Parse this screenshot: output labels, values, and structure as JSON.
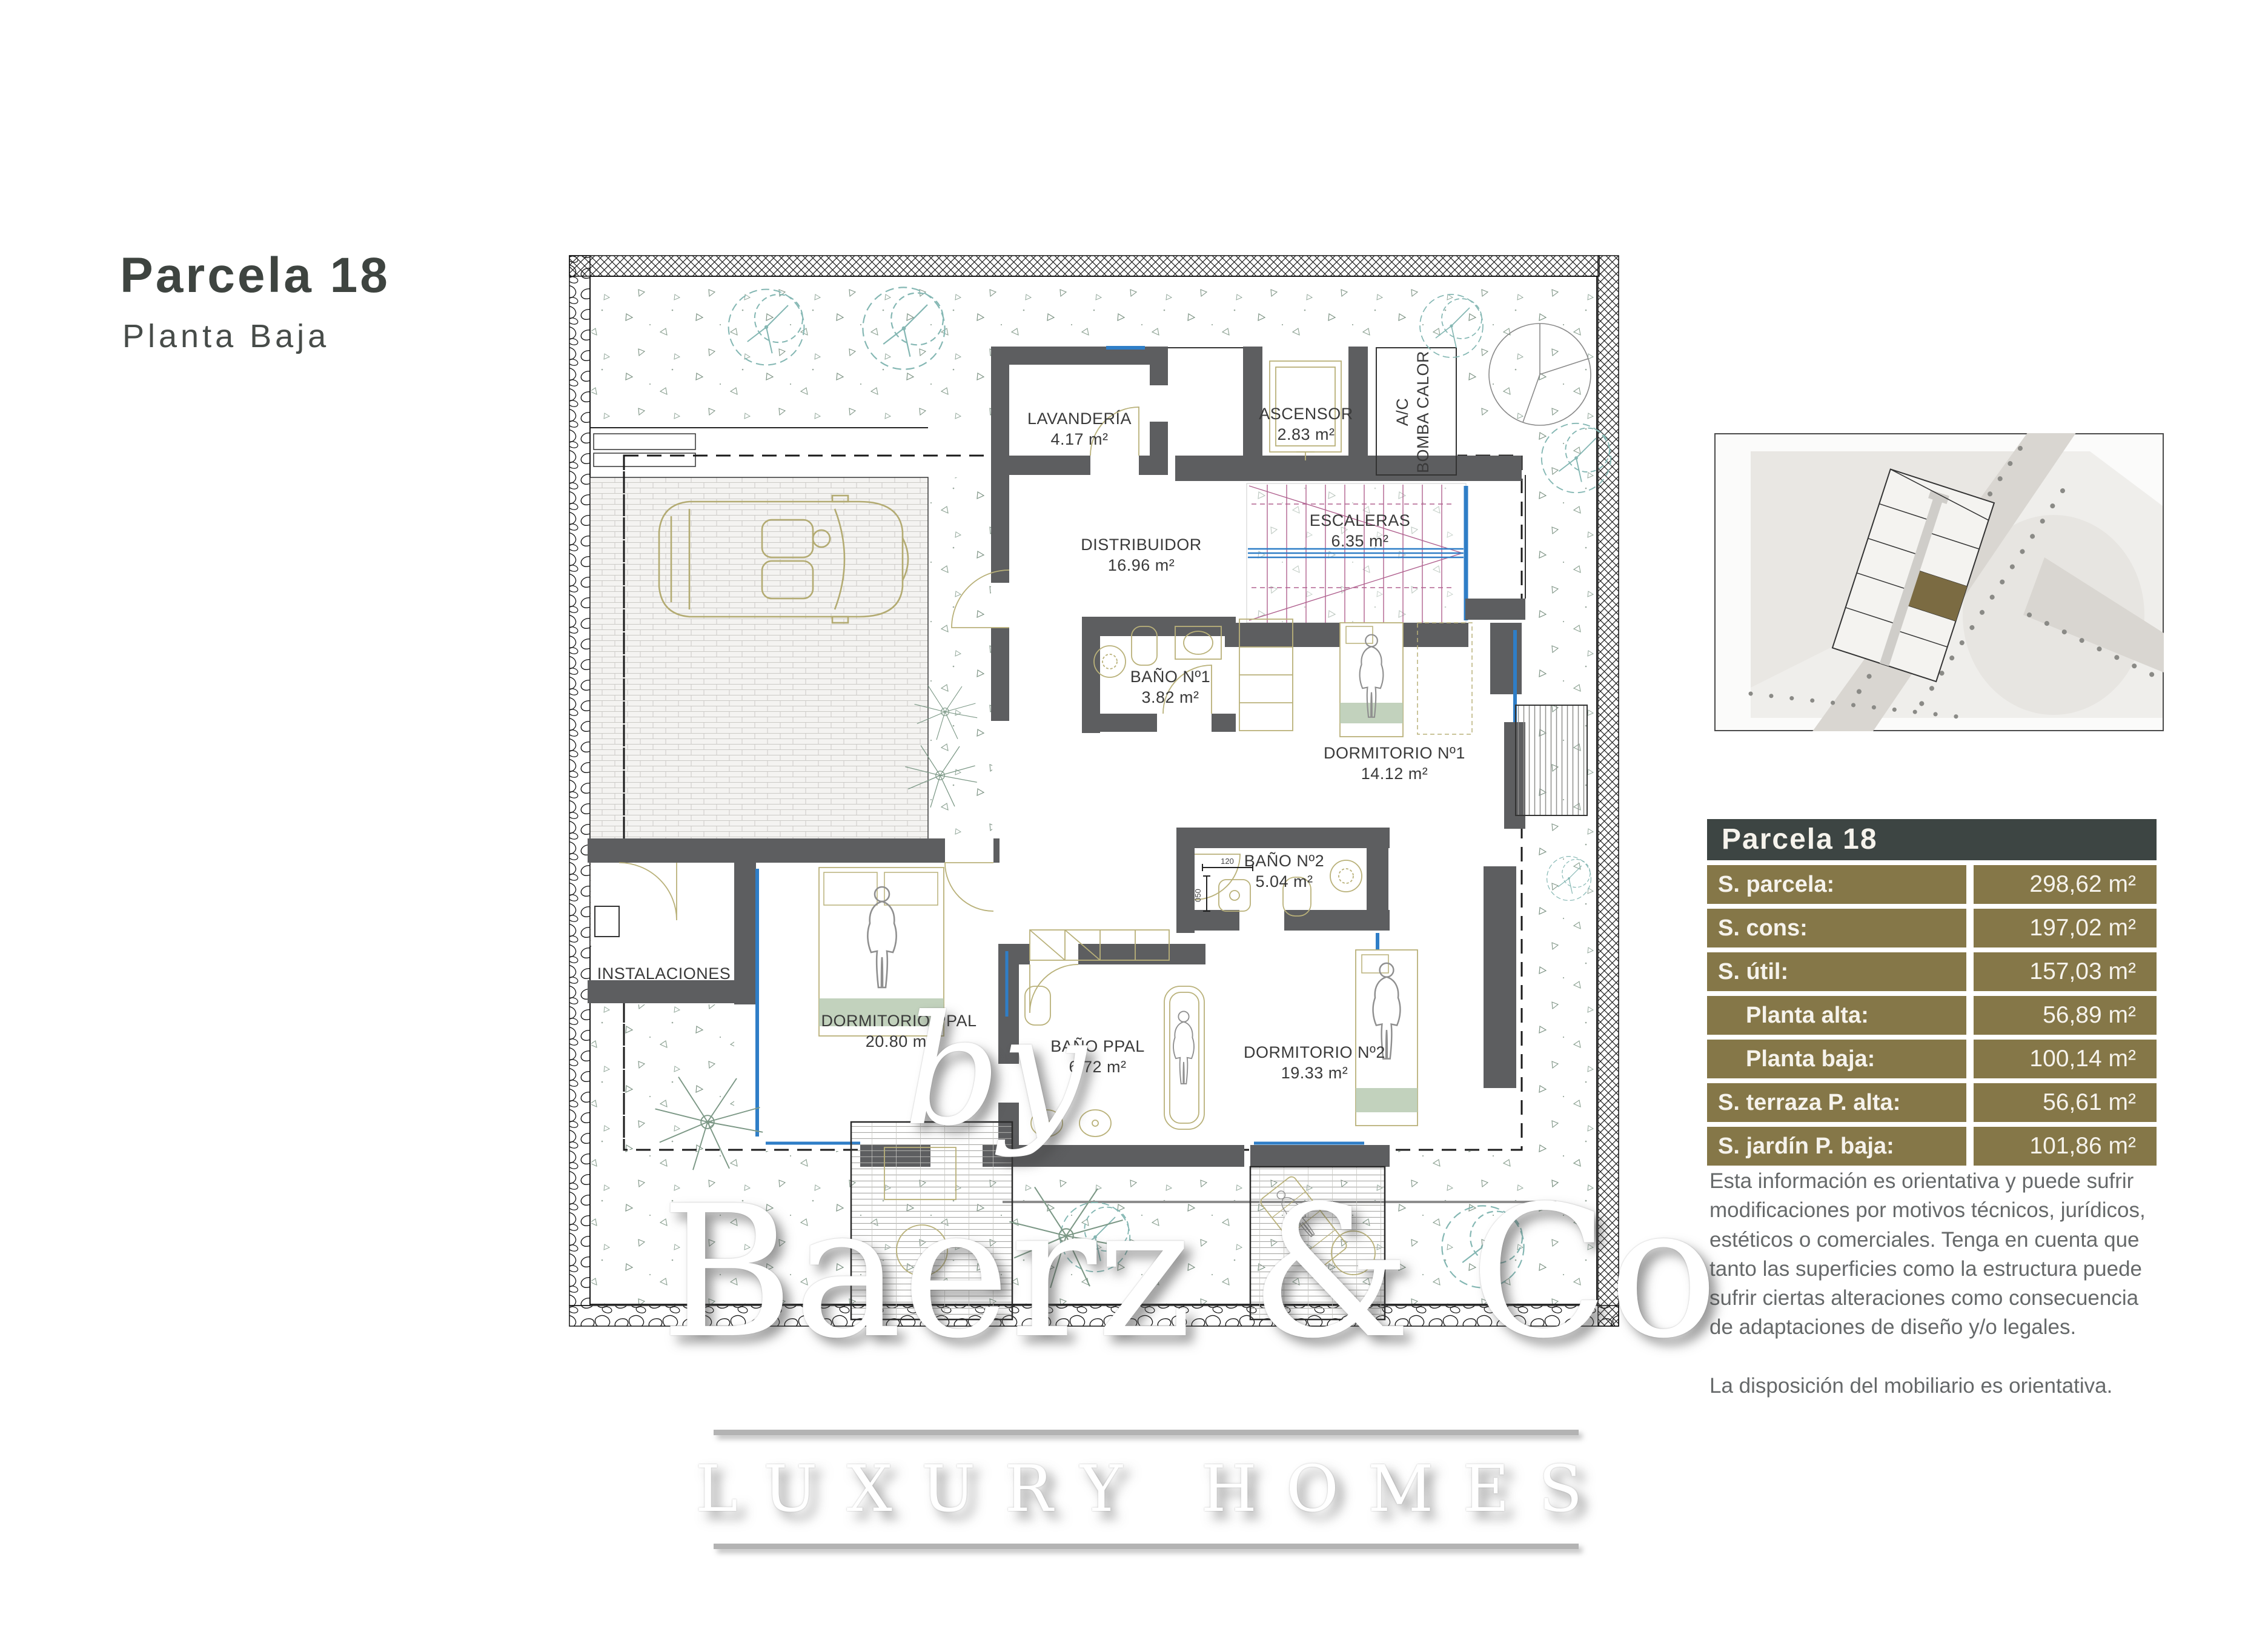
{
  "title": {
    "main": "Parcela 18",
    "subtitle": "Planta Baja"
  },
  "plan": {
    "rooms": {
      "lavanderia": {
        "name": "LAVANDERÍA",
        "area": "4.17 m²"
      },
      "ascensor": {
        "name": "ASCENSOR",
        "area": "2.83 m²"
      },
      "ac": {
        "line1": "A/C",
        "line2": "BOMBA CALOR"
      },
      "distribuidor": {
        "name": "DISTRIBUIDOR",
        "area": "16.96 m²"
      },
      "escaleras": {
        "name": "ESCALERAS",
        "area": "6.35 m²"
      },
      "bano1": {
        "name": "BAÑO Nº1",
        "area": "3.82 m²"
      },
      "dormitorio1": {
        "name": "DORMITORIO Nº1",
        "area": "14.12 m²"
      },
      "bano2": {
        "name": "BAÑO Nº2",
        "area": "5.04 m²"
      },
      "instalaciones": {
        "name": "INSTALACIONES"
      },
      "dormitorio_ppal": {
        "name": "DORMITORIO PPAL",
        "area": "20.80 m²"
      },
      "bano_ppal": {
        "name": "BAÑO PPAL",
        "area": "6.72 m²"
      },
      "dormitorio2": {
        "name": "DORMITORIO Nº2",
        "area": "19.33 m²"
      }
    },
    "dims": {
      "d1": "120",
      "d2": "050"
    }
  },
  "summary_table": {
    "header": "Parcela 18",
    "rows": [
      {
        "label": "S. parcela:",
        "value": "298,62 m²",
        "indent": false
      },
      {
        "label": "S. cons:",
        "value": "197,02 m²",
        "indent": false
      },
      {
        "label": "S. útil:",
        "value": "157,03 m²",
        "indent": false
      },
      {
        "label": "Planta alta:",
        "value": "56,89 m²",
        "indent": true
      },
      {
        "label": "Planta baja:",
        "value": "100,14 m²",
        "indent": true
      },
      {
        "label": "S. terraza P. alta:",
        "value": "56,61 m²",
        "indent": false
      },
      {
        "label": "S. jardín P. baja:",
        "value": "101,86 m²",
        "indent": false
      }
    ]
  },
  "disclaimer": {
    "paragraph1": "Esta información es orientativa y puede sufrir modificaciones por motivos técnicos, jurídicos, estéticos o comerciales. Tenga en cuenta que tanto las superficies como la estructura puede sufrir ciertas alteraciones como consecuencia de adaptaciones de diseño y/o legales.",
    "paragraph2": "La disposición del mobiliario es orientativa."
  },
  "watermark": {
    "by": "by",
    "brand": "Baerz & Co",
    "tagline": "LUXURY HOMES"
  },
  "colors": {
    "accent_olive": "#857748",
    "header_dark": "#3d4543",
    "wall_gray": "#5d5e60",
    "window_blue": "#2f7ec7",
    "stair_magenta": "#b0618f",
    "tree_teal": "#84b7b3",
    "furniture_olive": "#b9b179"
  }
}
